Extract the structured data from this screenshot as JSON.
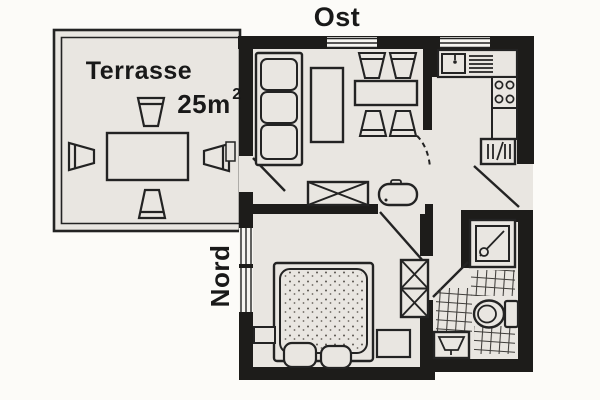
{
  "compass": {
    "east_label": "Ost",
    "north_label": "Nord"
  },
  "terrace": {
    "label": "Terrasse",
    "area": "25m",
    "area_exponent": "2"
  },
  "colors": {
    "paper": "#fcfbf8",
    "floor": "#e9e6e1",
    "wall": "#1d1c1a",
    "line": "#232323"
  }
}
